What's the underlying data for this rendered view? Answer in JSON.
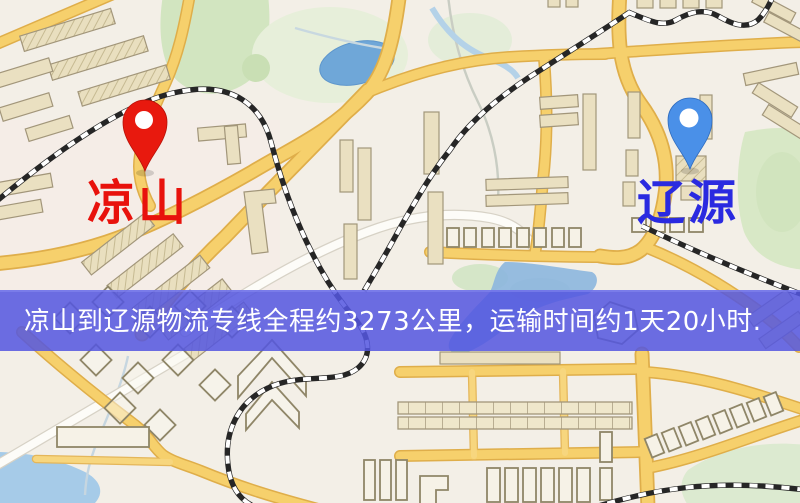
{
  "banner": {
    "text": "凉山到辽源物流专线全程约3273公里，运输时间约1天20小时.",
    "background_color": "#5456e0",
    "text_color": "#ffffff"
  },
  "pins": {
    "origin": {
      "label": "凉山",
      "pin_color": "#e8190e",
      "label_color": "#e8120c"
    },
    "destination": {
      "label": "辽源",
      "pin_color": "#4a90e8",
      "label_color": "#2a2ae0"
    }
  }
}
